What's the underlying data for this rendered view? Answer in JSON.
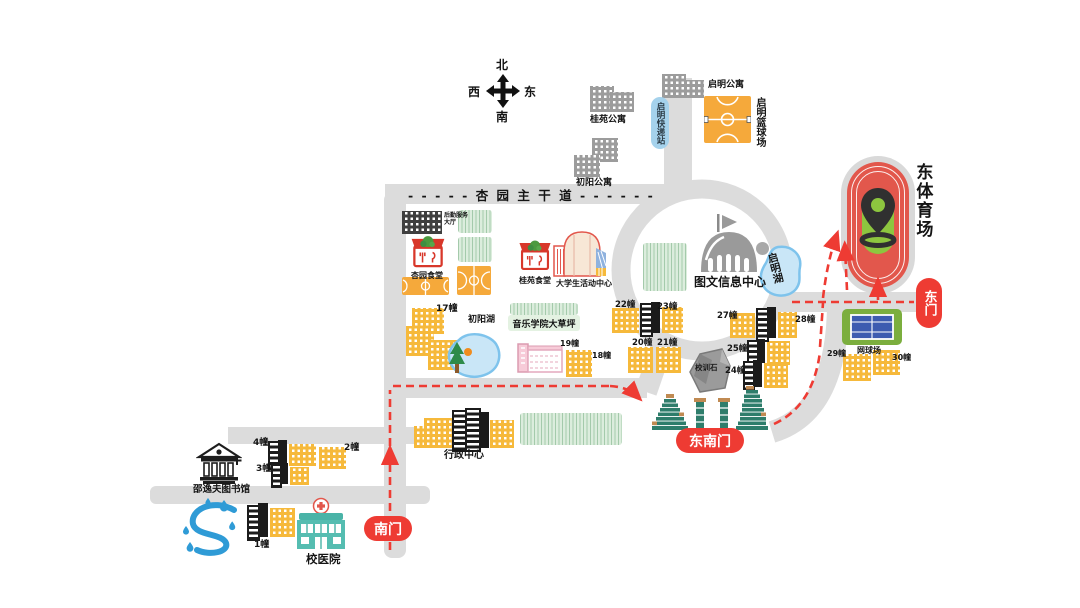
{
  "labels": {
    "north": "北",
    "west": "西",
    "east_dir": "东",
    "south": "南",
    "main_road": "- - - - - 杏 园 主 干 道 - - - - - -",
    "guiyuan_apartment": "桂苑公寓",
    "qiming_apartment": "启明公寓",
    "qiming_express": "启明快递站",
    "qiming_basketball": "启明篮球场",
    "chuyang_apartment": "初阳公寓",
    "logistics_hall": "后勤服务大厅",
    "xingyuan_canteen": "杏园食堂",
    "guiyuan_canteen": "桂苑食堂",
    "student_activity_center": "大学生活动中心",
    "library_info_center": "图文信息中心",
    "qiming_lake": "启明湖",
    "east_stadium": "东体育场",
    "east_gate": "东门",
    "tennis_court": "网球场",
    "b17": "17幢",
    "b18": "18幢",
    "b19": "19幢",
    "b20": "20幢",
    "b21": "21幢",
    "b22": "22幢",
    "b23": "23幢",
    "b24": "24幢",
    "b25": "25幢",
    "b27": "27幢",
    "b28": "28幢",
    "b29": "29幢",
    "b30": "30幢",
    "chuyang_lake": "初阳湖",
    "music_lawn": "音乐学院大草坪",
    "motto_stone": "校训石",
    "southeast_gate": "东南门",
    "admin_center": "行政中心",
    "b1": "1幢",
    "b2": "2幢",
    "b3": "3幢",
    "b4": "4幢",
    "shaw_library": "邵逸夫图书馆",
    "school_hospital": "校医院",
    "south_gate": "南门"
  },
  "colors": {
    "route_red": "#EE3B33",
    "road_gray": "#DCDCDC",
    "building_yellow": "#F6B93B",
    "apartment_gray": "#9C9C9C",
    "water_blue": "#C9E6F7",
    "water_border": "#7EC3EC",
    "grass_green": "#DCEDDD",
    "court_orange": "#F5A93B",
    "gate_green": "#2E7D6B",
    "track_red": "#E2574C",
    "field_green": "#8DC63F",
    "express_blue": "#A5D2EC",
    "hospital_teal": "#55BDB1",
    "canteen_red": "#D8372A"
  }
}
